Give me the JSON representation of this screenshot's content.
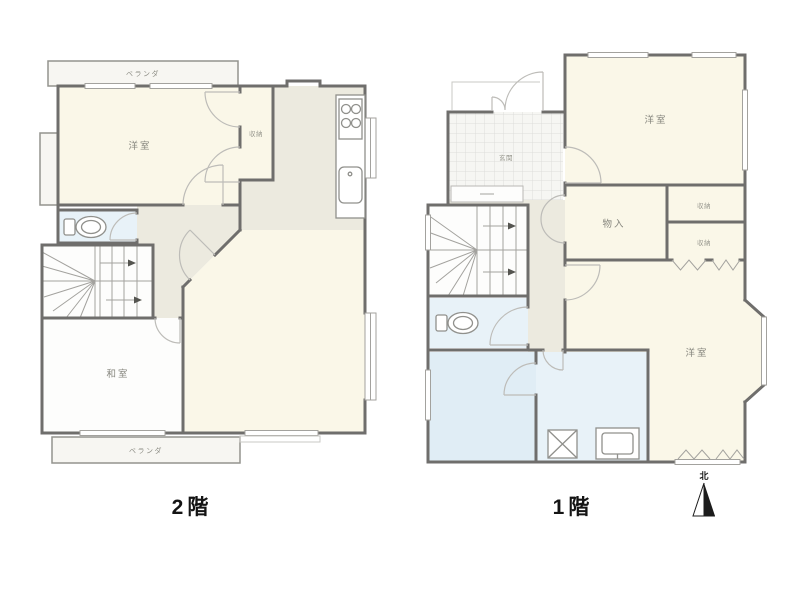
{
  "floor2": {
    "label": "2階",
    "balcony_top": "ベランダ",
    "balcony_bottom": "ベランダ",
    "western_room": "洋室",
    "closet": "収納",
    "japanese_room": "和室"
  },
  "floor1": {
    "label": "1階",
    "western_room_north": "洋室",
    "western_room_south": "洋室",
    "storage": "物入",
    "entrance": "玄関",
    "closet_top": "収納",
    "closet_bottom": "収納"
  },
  "compass": {
    "north": "北"
  },
  "colors": {
    "wall": "#6f6e6c",
    "room_cream": "#faf7e8",
    "hall_beige": "#eceadf",
    "wet_blue": "#e8f2f8",
    "bath_blue": "#e0edf5",
    "white_room": "#fdfdfc",
    "balcony": "#f7f6f2",
    "background": "#ffffff"
  }
}
